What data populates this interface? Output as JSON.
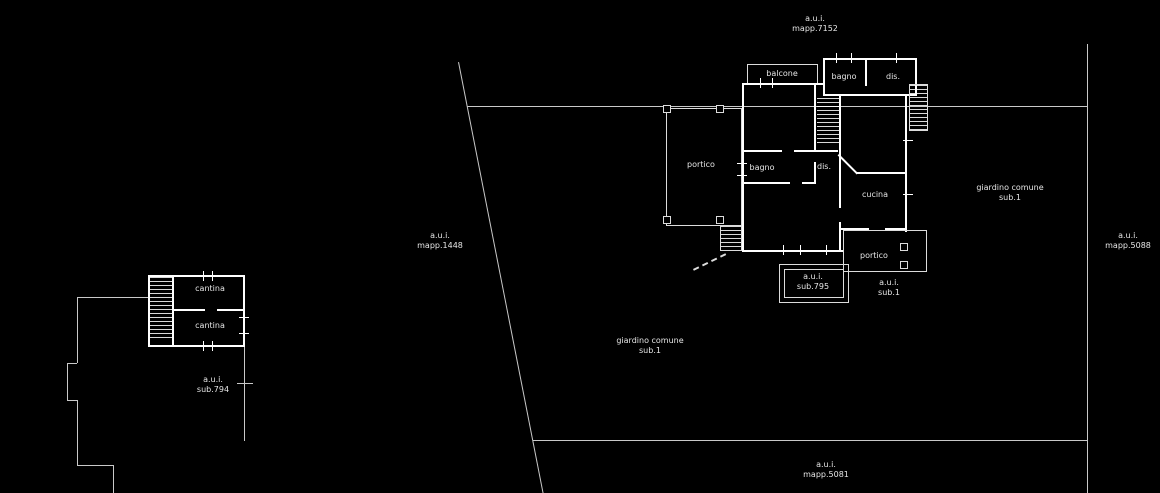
{
  "colors": {
    "background": "#000000",
    "wall": "#ffffff",
    "boundary": "#c9c9c9",
    "thin": "#dcdcdc",
    "text": "#e6e6e6"
  },
  "parcels": {
    "top": {
      "l1": "a.u.i.",
      "l2": "mapp.7152"
    },
    "left": {
      "l1": "a.u.i.",
      "l2": "mapp.1448"
    },
    "right": {
      "l1": "a.u.i.",
      "l2": "mapp.5088"
    },
    "bottom": {
      "l1": "a.u.i.",
      "l2": "mapp.5081"
    },
    "garden_right": {
      "l1": "giardino comune",
      "l2": "sub.1"
    },
    "garden_bottom": {
      "l1": "giardino comune",
      "l2": "sub.1"
    },
    "sub_794": {
      "l1": "a.u.i.",
      "l2": "sub.794"
    },
    "sub_795": {
      "l1": "a.u.i.",
      "l2": "sub.795"
    },
    "sub_1": {
      "l1": "a.u.i.",
      "l2": "sub.1"
    }
  },
  "rooms": {
    "balcone": "balcone",
    "bagno_upper": "bagno",
    "dis_upper": "dis.",
    "portico_west": "portico",
    "bagno_main": "bagno",
    "dis_main": "dis.",
    "cucina": "cucina",
    "portico_south": "portico",
    "cantina_north": "cantina",
    "cantina_south": "cantina"
  }
}
